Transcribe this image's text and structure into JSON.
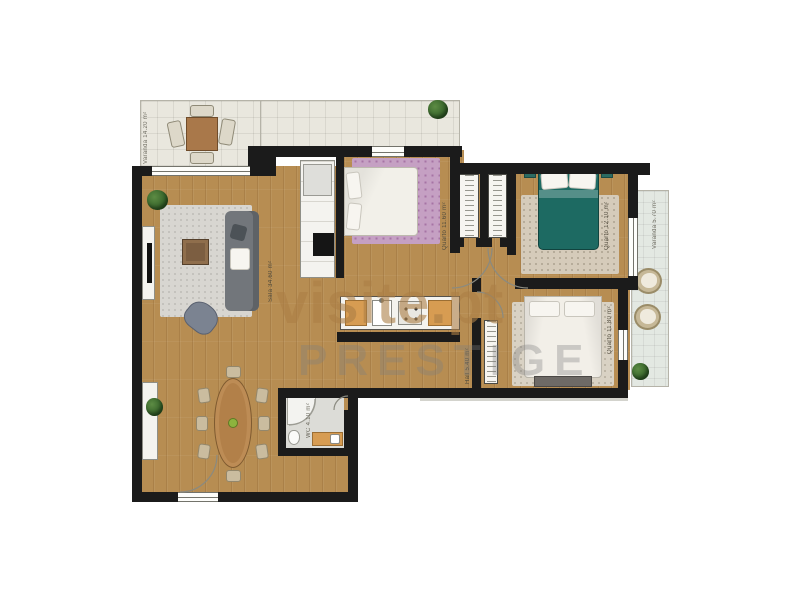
{
  "watermarks": {
    "site": "visite.pt",
    "agency": "PRESTIGE"
  },
  "rooms": {
    "terrace": {
      "label": "Varanda 14.20 m²"
    },
    "living": {
      "label": "Sala 34.60 m²"
    },
    "bedroom1": {
      "label": "Quarto 11.60 m²"
    },
    "bedroom2": {
      "label": "Quarto 12.10 m²"
    },
    "bedroom3": {
      "label": "Quarto 11.80 m²"
    },
    "hall": {
      "label": "Hall 5.40 m²"
    },
    "wc": {
      "label": "WC 4.10 m²"
    },
    "balcony": {
      "label": "Varanda 5.70 m²"
    }
  },
  "colors": {
    "wall": "#1b1b1b",
    "wood_floor": "#b78d52",
    "terrace_tile": "#e9e7de",
    "balcony_tile": "#e3e8e2",
    "bed_teal": "#1d6a62",
    "rug_pink": "#c5a0c3",
    "cabinet_orange": "#d79c52",
    "watermark_tan": "#ab7e46",
    "watermark_grey": "#7d7d7d"
  }
}
